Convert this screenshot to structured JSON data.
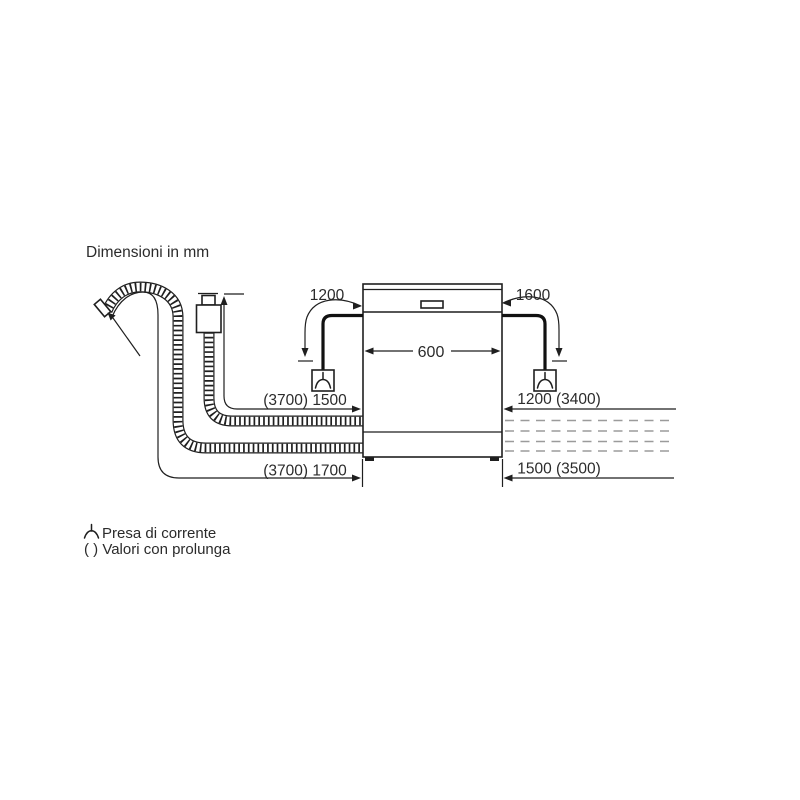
{
  "title": "Dimensioni in mm",
  "colors": {
    "line": "#1f1f1f",
    "dash": "#9b9b9b",
    "background": "#ffffff"
  },
  "dimensions": {
    "cable_left": "1200",
    "cable_right": "1600",
    "appliance_width": "600",
    "supply_hose": "(3700) 1500",
    "supply_extended": "1200 (3400)",
    "drain_hose": "(3700) 1700",
    "drain_extended": "1500 (3500)"
  },
  "legend": {
    "socket": {
      "icon": "power-socket-icon",
      "label": "Presa di corrente"
    },
    "prolunga": {
      "label": "( ) Valori con prolunga"
    }
  }
}
